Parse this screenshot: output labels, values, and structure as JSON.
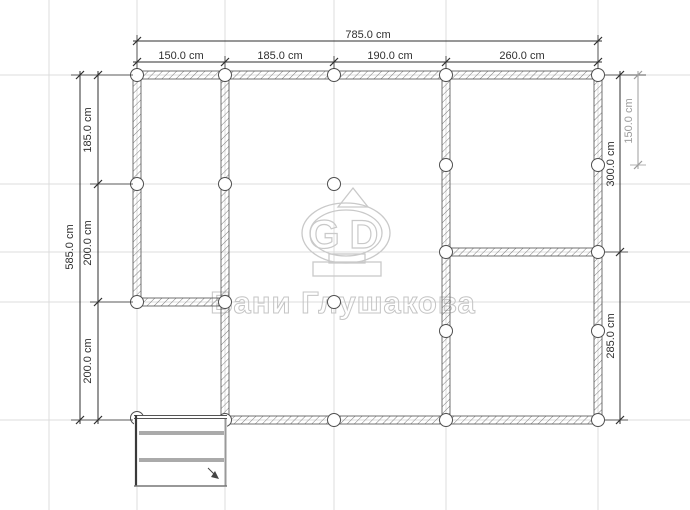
{
  "drawing": {
    "type": "foundation-plan",
    "units": "cm"
  },
  "watermark": {
    "brand_text": "Бани Глушакова",
    "logo_letter_left": "G",
    "logo_letter_right": "D"
  },
  "dimensions": {
    "top": {
      "overall": "785.0 cm",
      "segments": [
        "150.0 cm",
        "185.0 cm",
        "190.0 cm",
        "260.0 cm"
      ]
    },
    "left": {
      "overall": "585.0 cm",
      "segments": [
        "185.0 cm",
        "200.0 cm",
        "200.0 cm"
      ]
    },
    "right": {
      "segments": [
        "300.0 cm",
        "285.0 cm"
      ],
      "pile_offset": "150.0 cm"
    }
  },
  "colors": {
    "grid": "#dcdcdc",
    "wall_outline": "#4f4f4f",
    "dimension": "#2f2f2f",
    "dimension_secondary": "#9c9c9c",
    "watermark": "#c5c5c5"
  }
}
